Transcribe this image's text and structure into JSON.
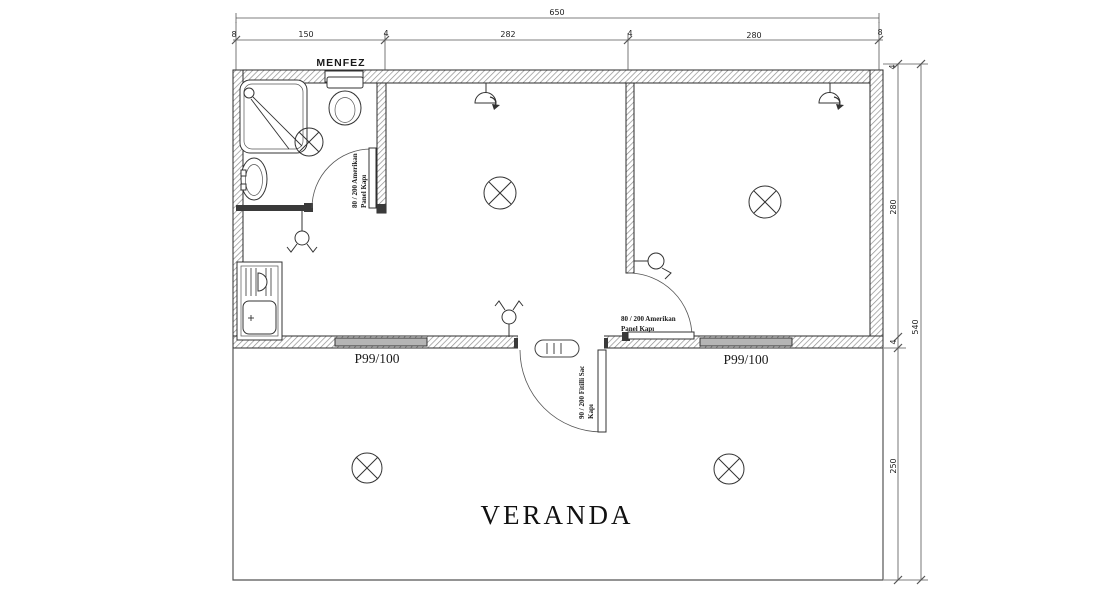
{
  "labels": {
    "menfez": "MENFEZ",
    "veranda": "VERANDA",
    "window_left": "P99/100",
    "window_right": "P99/100"
  },
  "doors": {
    "bath_door": {
      "size": "80 / 200 Amerikan",
      "type": "Panel Kapı"
    },
    "room_door": {
      "size": "80 / 200 Amerikan",
      "type": "Panel Kapı"
    },
    "entry_door": {
      "size": "90 / 200 Fitilli Sac",
      "type": "Kapı"
    }
  },
  "dimensions": {
    "top_total": "650",
    "top_segments": [
      "8",
      "150",
      "4",
      "282",
      "4",
      "280",
      "8"
    ],
    "right_segments": [
      "4",
      "280",
      "4",
      "250"
    ],
    "right_total": "540"
  },
  "colors": {
    "background": "#ffffff",
    "line": "#2b2b2b",
    "wall_hatch": "#8f8f8f",
    "window_fill": "#b5b5b5",
    "dimension_line": "#555555",
    "text": "#1a1a1a"
  }
}
